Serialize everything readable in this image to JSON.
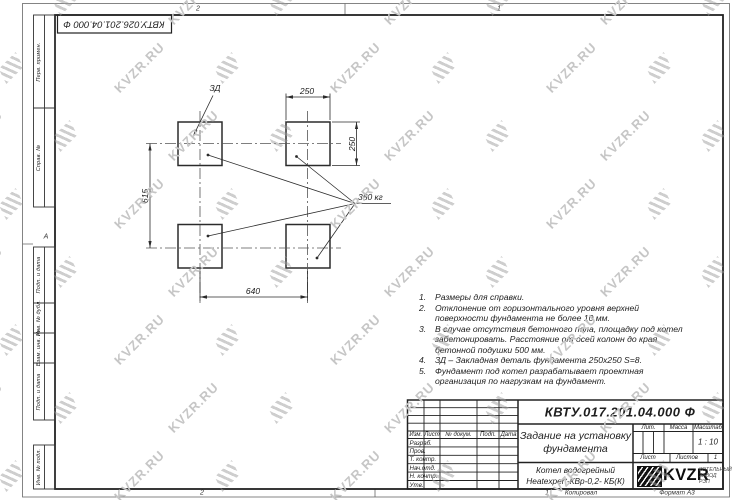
{
  "watermark": {
    "text": "KVZR.RU"
  },
  "sheet": {
    "top_designation": "КВТУ.026.201.04.000 Ф",
    "zone_top_left": "2",
    "zone_top_right": "1",
    "zone_bottom_left": "2",
    "zone_letter": "А",
    "margin_labels": [
      "Перв. примен.",
      "Справ. №",
      "Подп. и дата",
      "Инв. № дубл.",
      "Взам. инв. №",
      "Подп. и дата",
      "Инв. № подл."
    ],
    "footer": {
      "num": "1",
      "copied": "Копировал",
      "format": "Формат А3"
    }
  },
  "drawing": {
    "dims": {
      "top": "250",
      "right": "250",
      "left": "615",
      "bottom": "640"
    },
    "labels": {
      "zd": "ЗД",
      "weight": "350 кг"
    }
  },
  "notes": [
    {
      "num": "1.",
      "text": "Размеры для справки."
    },
    {
      "num": "2.",
      "text": "Отклонение от горизонтального уровня верхней поверхности фундамента не более 10 мм."
    },
    {
      "num": "3.",
      "text": "В случае отсутствия бетонного пола, площадку под котел забетонировать. Расстояние от осей колонн до края бетонной подушки 500 мм."
    },
    {
      "num": "4.",
      "text": "ЗД – Закладная деталь фундамента 250х250 S=8."
    },
    {
      "num": "5.",
      "text": "Фундамент под котел разрабатывает проектная организация по нагрузкам на фундамент."
    }
  ],
  "title_block": {
    "designation": "КВТУ.017.201.04.000 Ф",
    "title": "Задание на установку фундамента",
    "product": "Котел водогрейный Heatexpert-КВр-0,2- КБ(К)",
    "header_cols": [
      "Изм.",
      "Лист",
      "№ докум.",
      "Подп.",
      "Дата"
    ],
    "rows": [
      "Разраб.",
      "Пров.",
      "Т. контр.",
      "Нач.отд.",
      "Н. контр.",
      "Утв."
    ],
    "lit_label": "Лит.",
    "mass_label": "Масса",
    "scale_label": "Масштаб",
    "scale_value": "1 : 10",
    "sheet_label": "Лист",
    "sheets_label": "Листов",
    "sheets_value": "1",
    "logo_text": "KVZR",
    "logo_caption": "КОТЕЛЬНЫЙ ЗАВОД РЭП"
  }
}
